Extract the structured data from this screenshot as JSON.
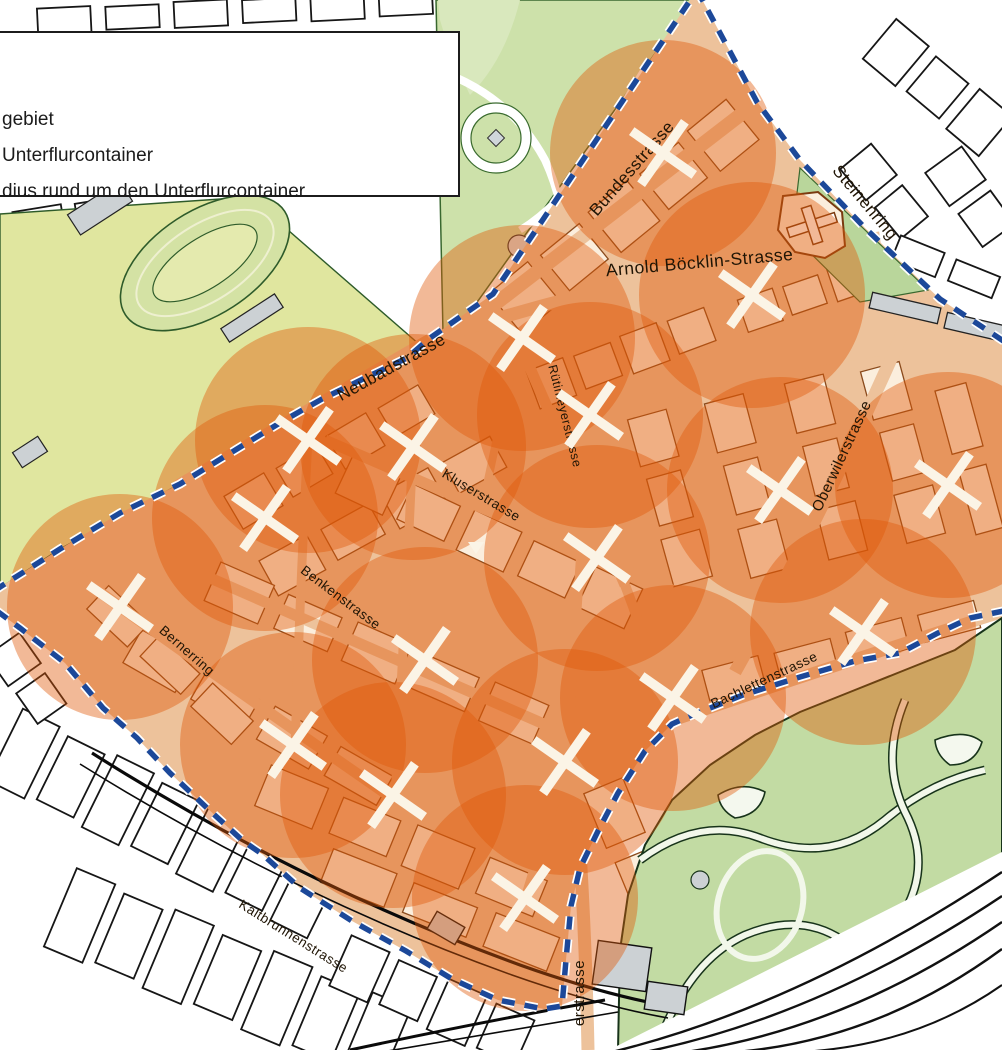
{
  "legend": {
    "lines": [
      "gebiet",
      "Unterflurcontainer",
      "dius rund um den Unterflurcontainer"
    ]
  },
  "map": {
    "radius_px": 113,
    "colors": {
      "pilot_street": "#edc29b",
      "pilot_building": "#fbeedd",
      "building_outline": "#8a4a1c",
      "outside_building": "#ffffff",
      "outside_outline": "#161616",
      "circle_fill": "#df5908",
      "circle_opacity": 0.42,
      "boundary_blue": "#1c4899",
      "marker_white": "#fbf4e6",
      "park_green": "#cde1aa",
      "park_outline": "#39682f",
      "field_green": "#e0e69f",
      "zoo_green": "#c2dba3",
      "gray_building": "#ccd1d4",
      "label_color": "#201505"
    },
    "boundary_path": "M697,-10 L757,102 L800,160 L865,228 L940,299 L1008,344 L1035,420 L1035,560 L1008,610 L970,618 L938,633 L900,653 L855,661 L800,677 L743,695 L690,716 L672,724 L645,751 L618,793 L598,831 L580,868 L571,906 L566,960 L562,1006 L544,1009 L498,1000 L452,979 L406,951 L352,921 L300,888 L262,854 L243,841 L207,808 L170,773 L137,738 L103,708 L65,663 L20,628 L-18,600 L0,587 L60,549 L120,513 L180,484 L237,449 L283,421 L322,399 L363,379 L407,358 L430,338 L493,294 Z",
    "markers": [
      {
        "x": 663,
        "y": 153
      },
      {
        "x": 522,
        "y": 338
      },
      {
        "x": 752,
        "y": 295
      },
      {
        "x": 308,
        "y": 440
      },
      {
        "x": 413,
        "y": 447
      },
      {
        "x": 590,
        "y": 415
      },
      {
        "x": 265,
        "y": 518
      },
      {
        "x": 597,
        "y": 558
      },
      {
        "x": 780,
        "y": 490
      },
      {
        "x": 948,
        "y": 485
      },
      {
        "x": 120,
        "y": 607
      },
      {
        "x": 425,
        "y": 660
      },
      {
        "x": 863,
        "y": 632
      },
      {
        "x": 293,
        "y": 745
      },
      {
        "x": 673,
        "y": 698
      },
      {
        "x": 565,
        "y": 762
      },
      {
        "x": 393,
        "y": 795
      },
      {
        "x": 525,
        "y": 898
      }
    ],
    "streets": [
      {
        "label": "Bundesstrasse",
        "x": 636,
        "y": 172,
        "rot": -49,
        "size": 17
      },
      {
        "label": "Arnold Böcklin-Strasse",
        "x": 700,
        "y": 268,
        "rot": -5,
        "size": 17.5
      },
      {
        "label": "Steinenring",
        "x": 861,
        "y": 206,
        "rot": 50,
        "size": 17
      },
      {
        "label": "Neubadstrasse",
        "x": 394,
        "y": 372,
        "rot": -29,
        "size": 17
      },
      {
        "label": "Rütimeyerstrasse",
        "x": 561,
        "y": 417,
        "rot": 76,
        "size": 12.5
      },
      {
        "label": "Oberwilerstrasse",
        "x": 846,
        "y": 458,
        "rot": -65,
        "size": 15
      },
      {
        "label": "Kluserstrasse",
        "x": 479,
        "y": 499,
        "rot": 31,
        "size": 13.5
      },
      {
        "label": "Benkenstrasse",
        "x": 338,
        "y": 601,
        "rot": 37,
        "size": 13.5
      },
      {
        "label": "Bernerring",
        "x": 184,
        "y": 654,
        "rot": 41,
        "size": 13.5
      },
      {
        "label": "Bachlettenstrasse",
        "x": 766,
        "y": 684,
        "rot": -25,
        "size": 13.5
      },
      {
        "label": "Kaltbrunnenstrasse",
        "x": 291,
        "y": 940,
        "rot": 32,
        "size": 13.5
      },
      {
        "label": "erstrasse",
        "x": 584,
        "y": 993,
        "rot": -90,
        "size": 15
      }
    ]
  }
}
